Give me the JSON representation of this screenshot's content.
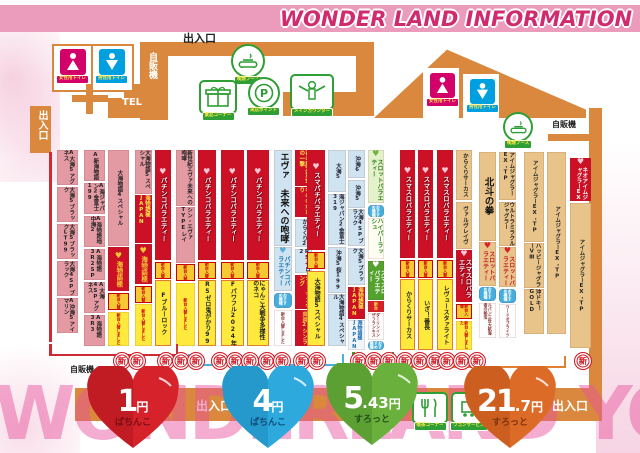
{
  "title": "WONDER LAND INFORMATION",
  "watermark": "WONDERLAND YOU&I",
  "labels": {
    "entrance_top": "出入口",
    "entrance_left": "出入口",
    "entrance_bottom_center": "出入口",
    "entrance_bottom_right": "出入口",
    "vending_top": "自販機",
    "vending_right": "自販機",
    "vending_bottom": "自販機",
    "tel": "TEL",
    "new_stamp": "新"
  },
  "facilities": {
    "female_toilet": "女性用トイレ",
    "male_toilet": "男性用トイレ",
    "smoking_booth": "喫煙ブース",
    "prize_corner": "景品コーナー",
    "visit_point": "来店ポイント",
    "main_counter": "メインカウンター",
    "cafe_corner": "喫茶コーナー",
    "wagon_service": "ワゴンサービス"
  },
  "rates": [
    {
      "amount": "1",
      "cents": "",
      "unit": "円",
      "sub": "ぱちんこ",
      "color": "#d6222a",
      "name": "red"
    },
    {
      "amount": "4",
      "cents": "",
      "unit": "円",
      "sub": "ぱちんこ",
      "color": "#2ea9dd",
      "name": "blue"
    },
    {
      "amount": "5",
      "cents": ".43",
      "unit": "円",
      "sub": "すろっと",
      "color": "#6ab03c",
      "name": "green"
    },
    {
      "amount": "21",
      "cents": ".7",
      "unit": "円",
      "sub": "すろっと",
      "color": "#dd6b28",
      "name": "orange"
    }
  ],
  "badges": {
    "gold": "新台入替",
    "blue": "おすすめ機種",
    "red": "新台"
  },
  "strips": [
    {
      "x": 57,
      "y": 150,
      "w": 21,
      "h": 183,
      "cols": [
        [
          {
            "t": "A大海5アグネス",
            "s": "pink",
            "f": 1
          },
          {
            "t": "大海5ブラック",
            "s": "pink",
            "f": 1
          },
          {
            "t": "大海5ブラックLT99",
            "s": "pink",
            "f": 1
          },
          {
            "t": "大海4SPブラック",
            "s": "pink",
            "f": 1
          },
          {
            "t": "A沖海5アイマリン",
            "s": "pink",
            "f": 1
          }
        ]
      ]
    },
    {
      "x": 84,
      "y": 150,
      "w": 45,
      "h": 196,
      "cols": [
        [
          {
            "t": "A新海物語",
            "s": "pink",
            "f": 1
          },
          {
            "t": "A海ジャパン2金富士199",
            "s": "pink",
            "f": 1
          },
          {
            "t": "A海物語地中海2",
            "s": "pink",
            "f": 1
          },
          {
            "t": "A海物語3R2SP",
            "s": "pink",
            "f": 1
          },
          {
            "t": "A大海4SPアグネス",
            "s": "pink",
            "f": 1
          },
          {
            "t": "A海物語3R3",
            "s": "pink",
            "f": 1
          }
        ],
        [
          {
            "t": "大海物語4スペシャル",
            "s": "pink",
            "f": 5
          },
          {
            "t": "海物語極",
            "s": "logo",
            "f": 2.3
          },
          {
            "t": "新台入替",
            "s": "gold",
            "f": 0.9
          },
          {
            "t": "新台入替しました",
            "s": "ytiny",
            "f": 1.8
          }
        ]
      ]
    },
    {
      "x": 135,
      "y": 150,
      "w": 36,
      "h": 196,
      "cols": [
        [
          {
            "t": "大海物語5スペシャル",
            "s": "pink",
            "f": 2.3
          },
          {
            "t": "海物語極JAPAN",
            "s": "redplain",
            "f": 2.5
          },
          {
            "t": "海物語極",
            "s": "logo",
            "f": 2.1
          },
          {
            "t": "新台入替",
            "s": "gold",
            "f": 0.9
          },
          {
            "t": "新台入替しました",
            "s": "ytiny",
            "f": 2.2
          }
        ],
        [
          {
            "t": "パチンコバラエティー",
            "s": "red",
            "f": 5.7
          },
          {
            "t": "新台入替",
            "s": "gold",
            "f": 0.9
          },
          {
            "t": "Fブルーロック",
            "s": "yellow",
            "f": 3.4
          }
        ]
      ]
    },
    {
      "x": 176,
      "y": 150,
      "w": 40,
      "h": 196,
      "cols": [
        [
          {
            "t": "新世紀エヴァ未来への咆哮",
            "s": "pink",
            "f": 2.9
          },
          {
            "t": "シン・エヴァTYPEレイ",
            "s": "pink",
            "f": 2.9
          },
          {
            "t": "新台入替",
            "s": "gold",
            "f": 0.9
          },
          {
            "t": "新台入替しました",
            "s": "ytiny",
            "f": 3.3
          }
        ],
        [
          {
            "t": "パチンコバラエティー",
            "s": "red",
            "f": 5.7
          },
          {
            "t": "新台入替",
            "s": "gold",
            "f": 0.9
          },
          {
            "t": "R5ゼロ鬼がかり99",
            "s": "yellow",
            "f": 3.4
          }
        ]
      ]
    },
    {
      "x": 221,
      "y": 150,
      "w": 48,
      "h": 196,
      "cols": [
        [
          {
            "t": "パチンコバラエティー",
            "s": "red",
            "f": 5.7
          },
          {
            "t": "新台入替",
            "s": "gold",
            "f": 0.9
          },
          {
            "t": "Fパワフル2024年",
            "s": "yellow",
            "f": 3.4
          }
        ],
        [
          {
            "t": "パチンコバラエティー",
            "s": "red",
            "f": 5.7
          },
          {
            "t": "新台入替",
            "s": "gold",
            "f": 0.9
          },
          {
            "t": "にゃんこ大戦争多様性のネコ",
            "s": "yellow",
            "f": 3.4
          }
        ]
      ]
    },
    {
      "x": 274,
      "y": 150,
      "w": 38,
      "h": 196,
      "cols": [
        [
          {
            "t": "エヴァ 未来への咆哮",
            "s": "bluebig",
            "f": 5.0
          },
          {
            "t": "パチンコバラエティー",
            "s": "bluehdr",
            "f": 2.3
          },
          {
            "t": "おすすめ機種",
            "s": "bbadge",
            "f": 0.8
          },
          {
            "t": "新台入替しました",
            "s": "whitetiny",
            "f": 1.9
          }
        ],
        [
          {
            "t": "花の慶次黄金の一撃",
            "s": "redplain",
            "f": 1.9
          },
          {
            "t": "もののがたり",
            "s": "redplain",
            "f": 1.6
          },
          {
            "t": "からくり2",
            "s": "blue",
            "f": 1.5
          },
          {
            "t": "R5ゼロ2",
            "s": "blue",
            "f": 1.3
          },
          {
            "t": "シャーマンキング",
            "s": "redplain",
            "f": 1.8
          },
          {
            "t": "炎炎2シンラ",
            "s": "redplain",
            "f": 1.9
          }
        ]
      ]
    },
    {
      "x": 307,
      "y": 150,
      "w": 39,
      "h": 196,
      "cols": [
        [
          {
            "t": "スマパチバラエティー",
            "s": "red",
            "f": 5.2
          },
          {
            "t": "新台入替",
            "s": "gold",
            "f": 0.9
          },
          {
            "t": "大海物語5スペシャル",
            "s": "yellow",
            "f": 3.9
          }
        ],
        [
          {
            "t": "大海5",
            "s": "blue",
            "f": 2.2
          },
          {
            "t": "海ジャパン2金富士319",
            "s": "blue",
            "f": 2.7
          },
          {
            "t": "沖海5桜199",
            "s": "blue",
            "f": 2.4
          },
          {
            "t": "大海物語4スペシャル",
            "s": "blue",
            "f": 2.7
          }
        ]
      ]
    },
    {
      "x": 348,
      "y": 150,
      "w": 36,
      "h": 200,
      "cols": [
        [
          {
            "t": "沖海6",
            "s": "blue",
            "f": 1.5
          },
          {
            "t": "沖海5",
            "s": "blue",
            "f": 1.5
          },
          {
            "t": "大海4SPブラック",
            "s": "blue",
            "f": 2.0
          },
          {
            "t": "大海5ブラック",
            "s": "blue",
            "f": 2.0
          },
          {
            "t": "海物語極JAPAN",
            "s": "redplain",
            "f": 1.7
          },
          {
            "t": "海物語極JAPAN",
            "s": "whiteblue",
            "f": 1.6
          }
        ],
        [
          {
            "t": "スロットバラエティー",
            "s": "grnhdr",
            "f": 3.0
          },
          {
            "t": "おすすめ機種",
            "s": "bbadge",
            "f": 0.7
          },
          {
            "t": "ハイパーラッシュ",
            "s": "whitegrn",
            "f": 2.3
          },
          {
            "t": "スマスロバラエティー",
            "s": "grn",
            "f": 2.2
          },
          {
            "t": "新台",
            "s": "rbadge",
            "f": 0.6
          },
          {
            "t": "ダーリンインザフランキス",
            "s": "whitetiny",
            "f": 1.5
          },
          {
            "t": "おすすめ機種",
            "s": "bbadge",
            "f": 0.5
          }
        ]
      ]
    },
    {
      "x": 400,
      "y": 150,
      "w": 33,
      "h": 200,
      "cols": [
        [
          {
            "t": "スマスロバラエティー",
            "s": "red",
            "f": 5.5
          },
          {
            "t": "新台入替",
            "s": "gold",
            "f": 0.9
          },
          {
            "t": "からくりサーカス",
            "s": "yellow",
            "f": 3.6
          }
        ],
        [
          {
            "t": "スマスロバラエティー",
            "s": "red",
            "f": 5.5
          },
          {
            "t": "新台入替",
            "s": "gold",
            "f": 0.9
          },
          {
            "t": "いざ！番長",
            "s": "yellow",
            "f": 3.6
          }
        ]
      ]
    },
    {
      "x": 437,
      "y": 150,
      "w": 35,
      "h": 200,
      "cols": [
        [
          {
            "t": "スマスロバラエティー",
            "s": "red",
            "f": 5.5
          },
          {
            "t": "新台入替",
            "s": "gold",
            "f": 0.9
          },
          {
            "t": "レヴュースタァライト",
            "s": "yellow",
            "f": 3.6
          }
        ],
        [
          {
            "t": "からくりサーカス",
            "s": "tan",
            "f": 2.6
          },
          {
            "t": "ヴァルヴレイヴ",
            "s": "tan",
            "f": 2.4
          },
          {
            "t": "スマスロバラエティー",
            "s": "redshort",
            "f": 2.7
          },
          {
            "t": "新台入替",
            "s": "gold",
            "f": 0.8
          },
          {
            "t": "新台入替しました",
            "s": "ytiny",
            "f": 1.5
          }
        ]
      ]
    },
    {
      "x": 479,
      "y": 152,
      "w": 37,
      "h": 186,
      "cols": [
        [
          {
            "t": "北斗の拳",
            "s": "tanbig",
            "f": 4.5
          },
          {
            "t": "スロットバラエティー",
            "s": "tanhdr",
            "f": 2.2
          },
          {
            "t": "おすすめ機種",
            "s": "bbadge",
            "f": 0.7
          },
          {
            "t": "ルパン三世大航海者の秘宝",
            "s": "whitetiny",
            "f": 1.8
          }
        ],
        [
          {
            "t": "アイムジャグラーEX・TP",
            "s": "tan",
            "f": 2.4
          },
          {
            "t": "ウルトラミラクルジャグラー",
            "s": "tan",
            "f": 2.2
          },
          {
            "t": "スロットバラエティー",
            "s": "tanhdr",
            "f": 2.0
          },
          {
            "t": "おすすめ機種",
            "s": "bbadge",
            "f": 0.7
          },
          {
            "t": "ワードオブライツ",
            "s": "whitetiny",
            "f": 1.7
          }
        ]
      ]
    },
    {
      "x": 524,
      "y": 152,
      "w": 42,
      "h": 182,
      "cols": [
        [
          {
            "t": "アイムジャグラーEX・TP",
            "s": "tan",
            "f": 5
          },
          {
            "t": "ハッピージャグラーVⅢ",
            "s": "tan",
            "f": 2.5
          },
          {
            "t": "沖ドキ！GOLD",
            "s": "tan",
            "f": 2.5
          }
        ],
        [
          {
            "t": "アイムジャグラーEX・TP",
            "s": "tan",
            "f": 10
          }
        ]
      ]
    },
    {
      "x": 570,
      "y": 158,
      "w": 21,
      "h": 190,
      "cols": [
        [
          {
            "t": "ネオアイムジャグラーEX",
            "s": "redhdr13",
            "f": 2.3
          },
          {
            "t": "アイムジャグラーEX・TP",
            "s": "tan",
            "f": 7.7
          }
        ]
      ]
    }
  ],
  "brackets": [
    {
      "x": 49,
      "w": 129,
      "y": 330,
      "color": "#d02a33",
      "riser": true
    },
    {
      "x": 188,
      "w": 156,
      "y": 340,
      "color": "#49b0e0",
      "riser": false
    },
    {
      "x": 352,
      "w": 42,
      "y": 338,
      "color": "#3a9a3a",
      "riser": false
    },
    {
      "x": 400,
      "w": 166,
      "y": 342,
      "color": "#e08030",
      "riser": false
    }
  ],
  "stamps": [
    {
      "x": 113,
      "n": 2
    },
    {
      "x": 157,
      "n": 3
    },
    {
      "x": 211,
      "n": 3
    },
    {
      "x": 258,
      "n": 2
    },
    {
      "x": 293,
      "n": 2
    },
    {
      "x": 350,
      "n": 3
    },
    {
      "x": 396,
      "n": 3
    },
    {
      "x": 438,
      "n": 3
    },
    {
      "x": 574,
      "n": 1
    }
  ]
}
